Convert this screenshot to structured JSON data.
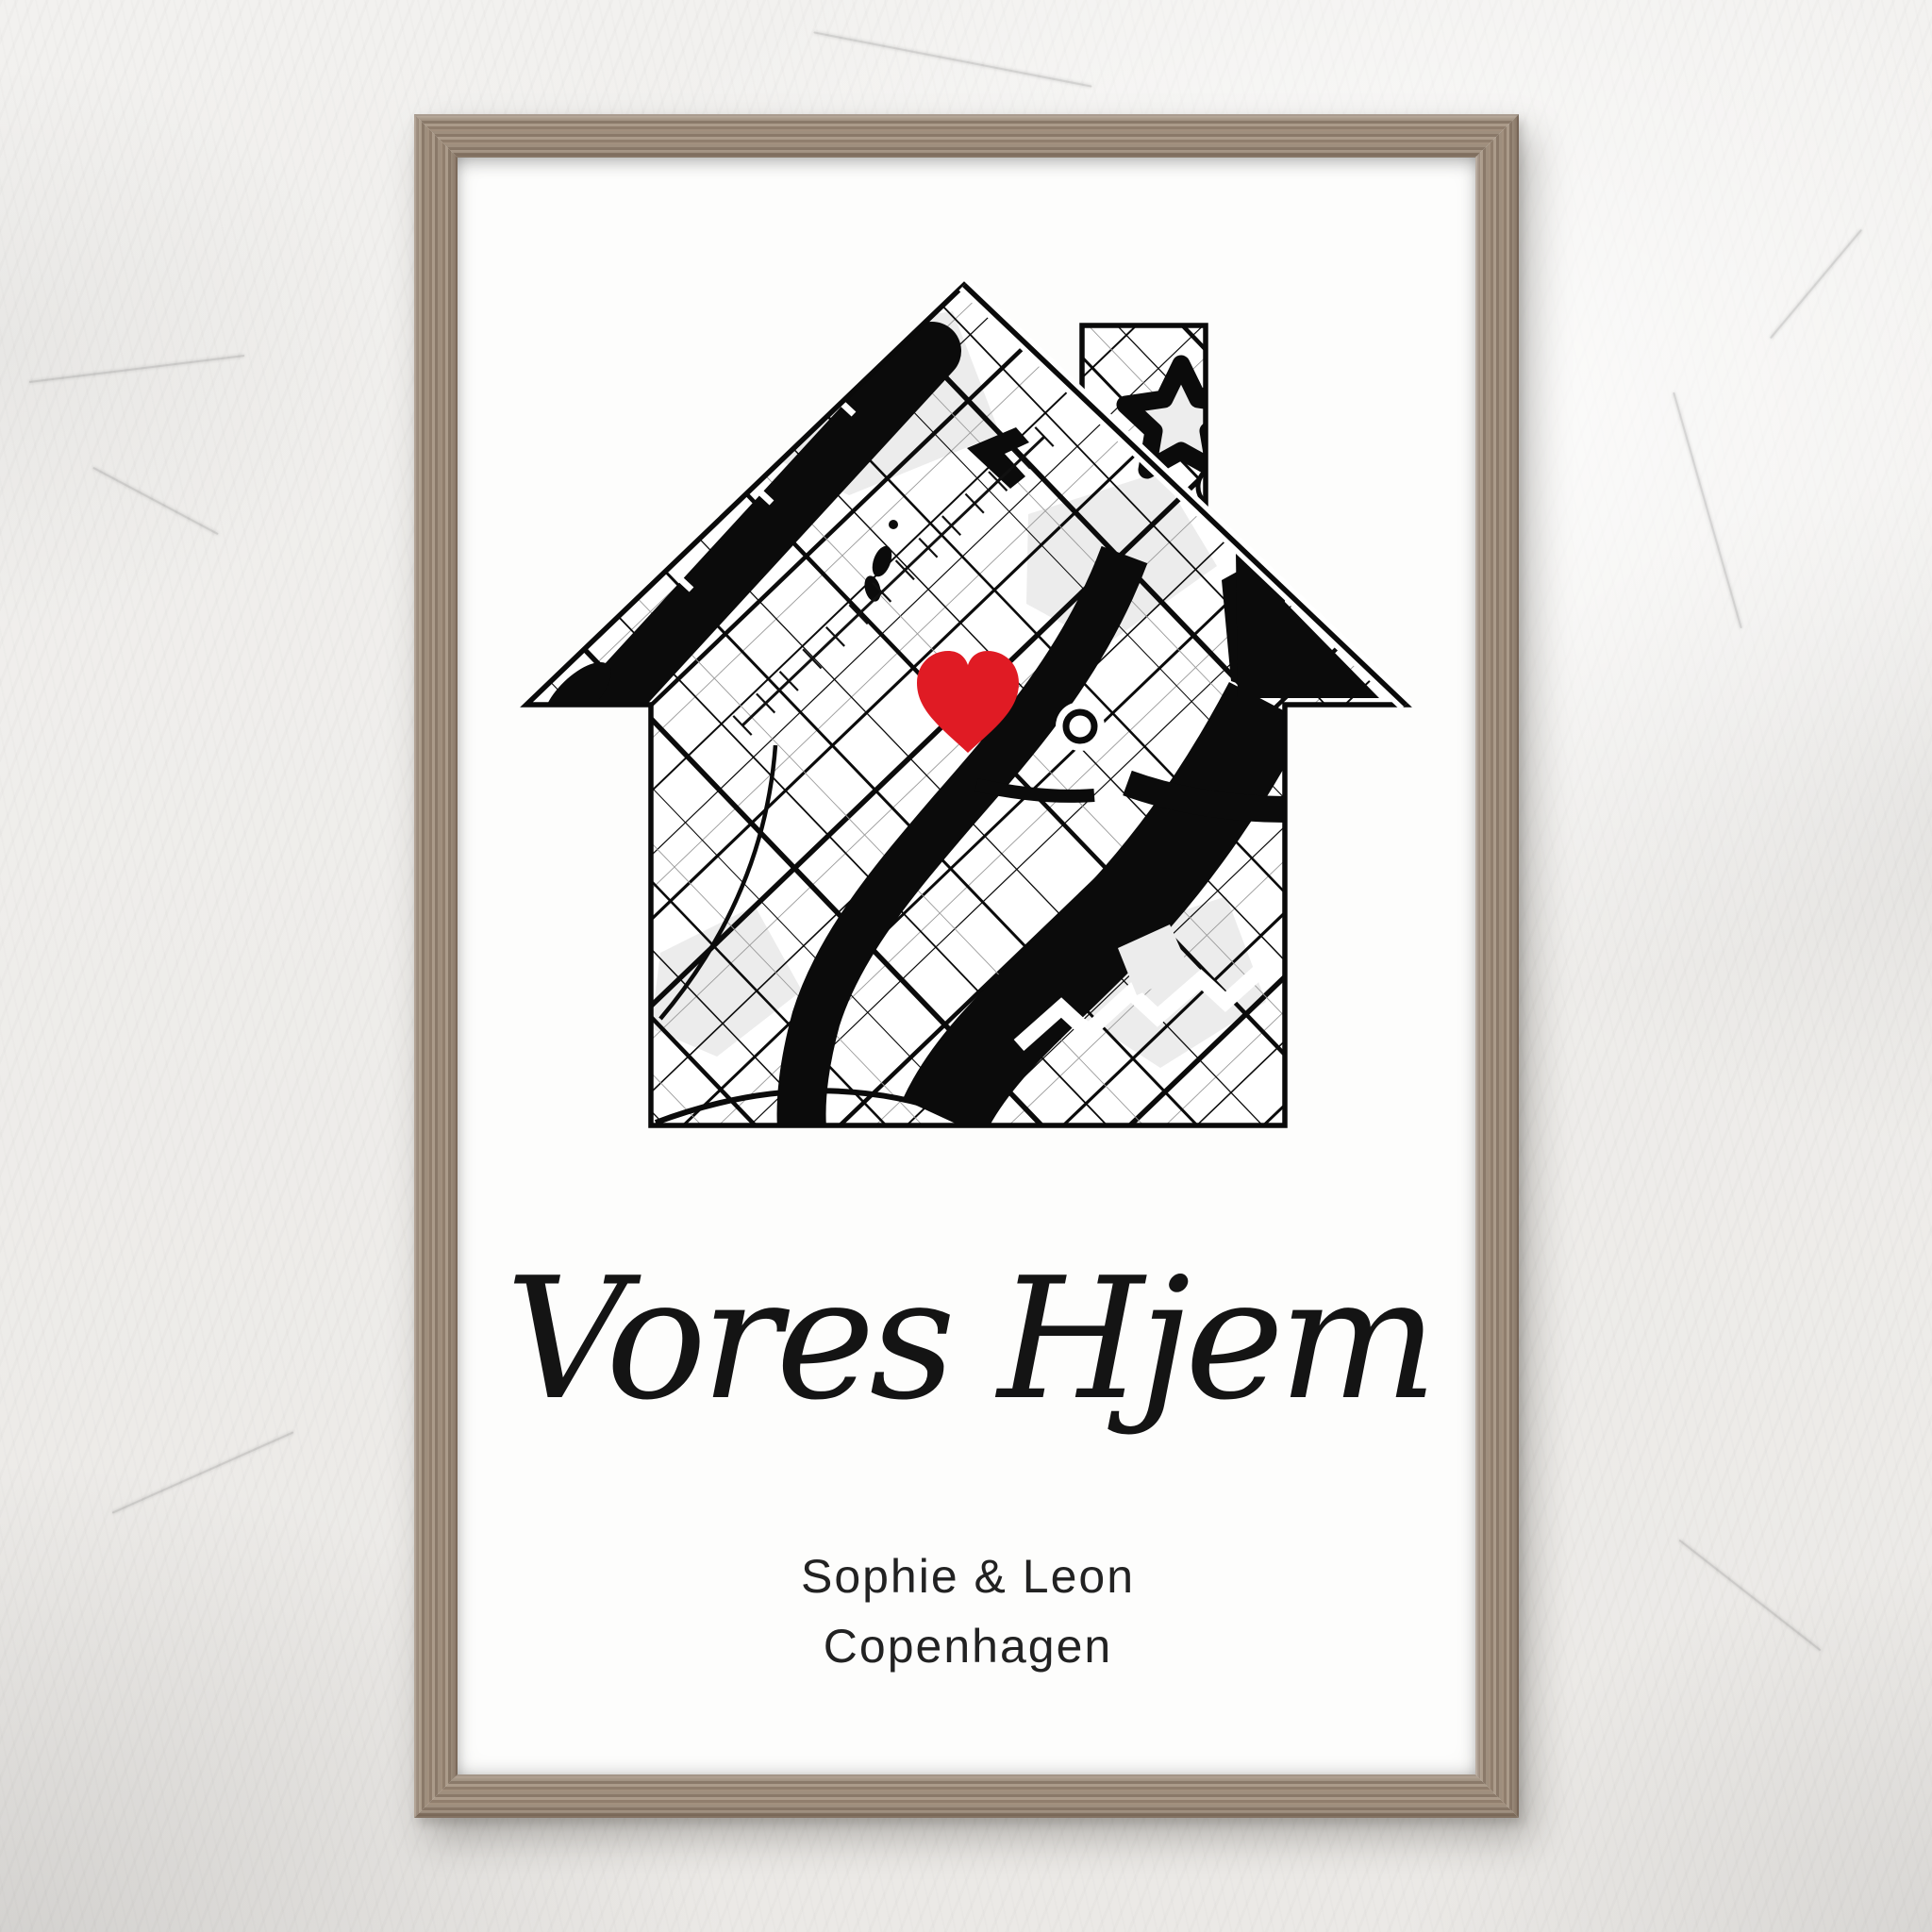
{
  "poster": {
    "script_title": "Vores Hjem",
    "names_line": "Sophie & Leon",
    "city_line": "Copenhagen"
  },
  "map": {
    "kind": "monochrome city street map",
    "silhouette": "house with chimney",
    "marker": "heart"
  },
  "colors": {
    "heart": "#e01b24",
    "map_ink": "#0b0b0b",
    "park": "#ececec",
    "wood": "#9c8b7a",
    "text": "#222222"
  }
}
